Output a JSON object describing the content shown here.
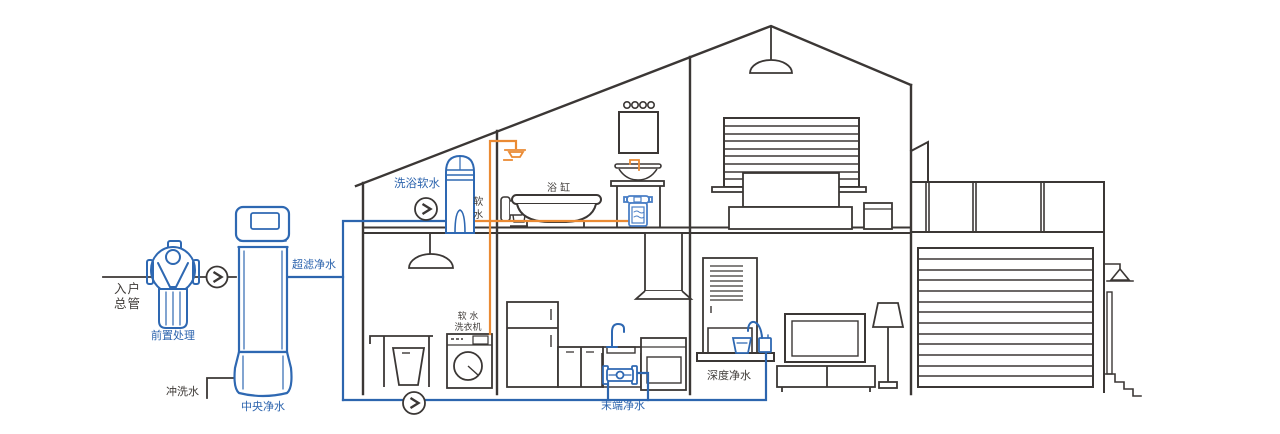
{
  "diagram": {
    "type": "whole-house water purification system illustration",
    "colors": {
      "line": "#3b3735",
      "pipe_blue": "#2c65ae",
      "pipe_orange": "#ea8a33",
      "background": "#ffffff"
    },
    "flow_indicators": {
      "count": 3,
      "symbol": ">"
    }
  },
  "labels": {
    "inlet_main": "入户\n总管",
    "pre_treatment": "前置处理",
    "central_purifier": "中央净水",
    "ultrafiltration": "超滤净水",
    "flush_water": "冲洗水",
    "bath_softener": "洗浴软水",
    "soft_water": "软水",
    "bathtub": "浴 缸",
    "soft_water_washer": "软 水\n洗衣机",
    "terminal_purifier": "末端净水",
    "deep_purifier": "深度净水"
  }
}
